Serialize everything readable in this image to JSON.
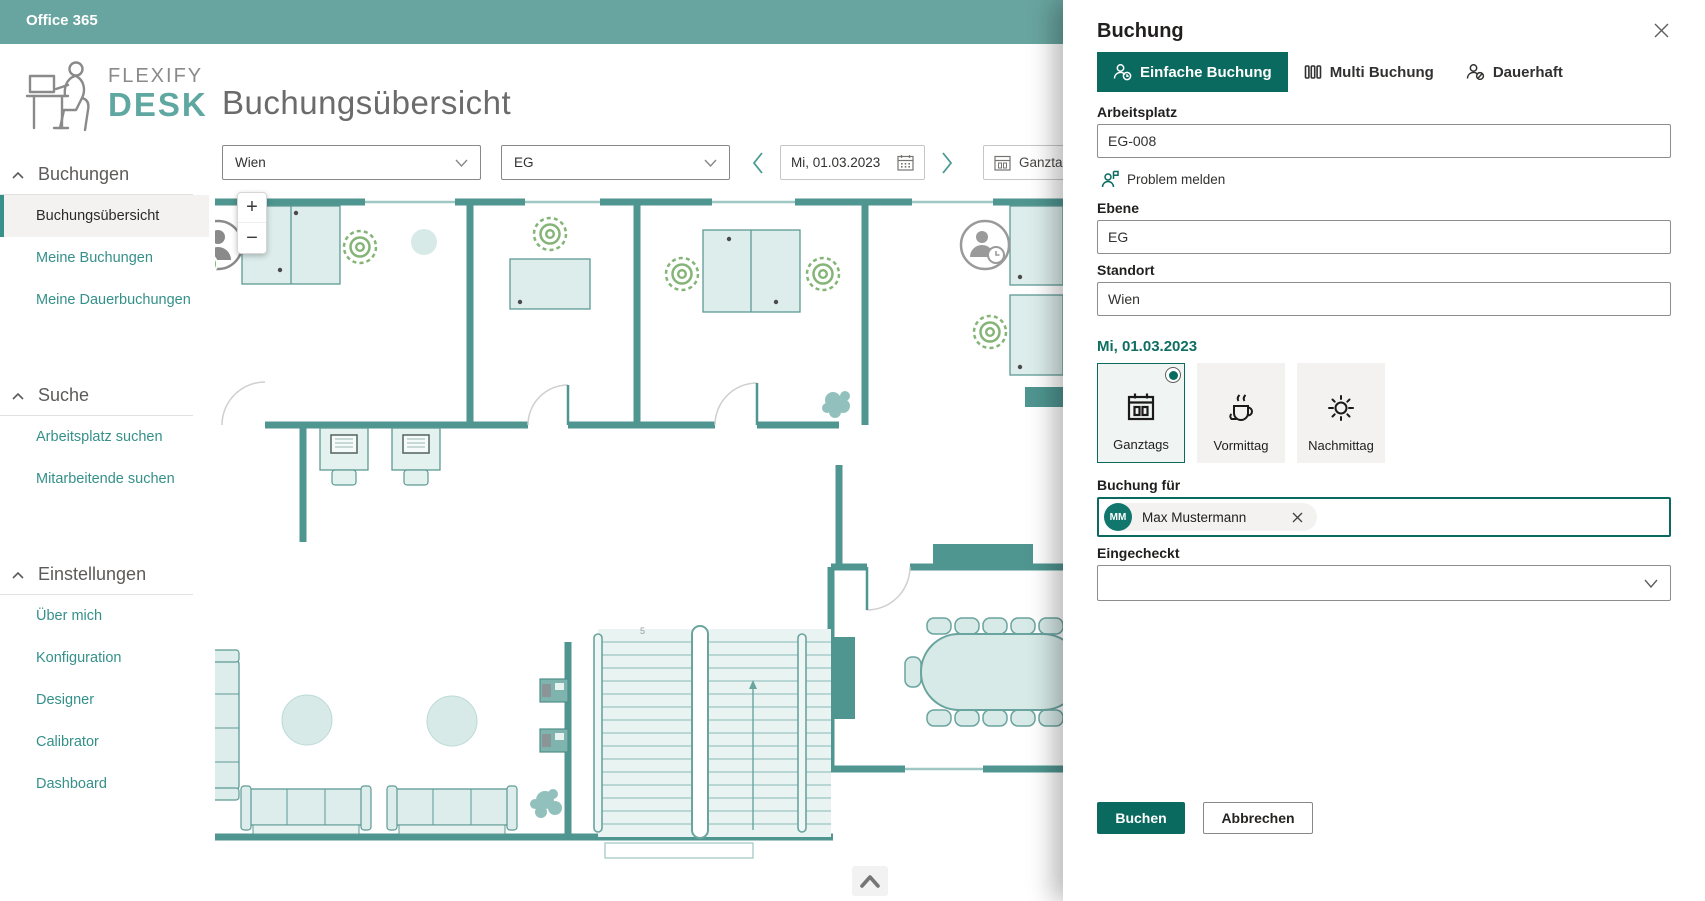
{
  "colors": {
    "top_bar": "#69a5a0",
    "brand_teal": "#5fa8a1",
    "accent": "#0b6a5f",
    "link_teal": "#35908a",
    "wall_teal": "#4f9590",
    "indicator_green": "#84b476"
  },
  "top_bar": {
    "app_title": "Office 365"
  },
  "logo": {
    "word1": "FLEXIFY",
    "word2": "DESK"
  },
  "sidebar": {
    "sections": [
      {
        "label": "Buchungen",
        "items": [
          {
            "label": "Buchungsübersicht",
            "active": true
          },
          {
            "label": "Meine Buchungen",
            "active": false
          },
          {
            "label": "Meine Dauerbuchungen",
            "active": false
          }
        ]
      },
      {
        "label": "Suche",
        "items": [
          {
            "label": "Arbeitsplatz suchen",
            "active": false
          },
          {
            "label": "Mitarbeitende suchen",
            "active": false
          }
        ]
      },
      {
        "label": "Einstellungen",
        "items": [
          {
            "label": "Über mich",
            "active": false
          },
          {
            "label": "Konfiguration",
            "active": false
          },
          {
            "label": "Designer",
            "active": false
          },
          {
            "label": "Calibrator",
            "active": false
          },
          {
            "label": "Dashboard",
            "active": false
          }
        ]
      }
    ]
  },
  "main": {
    "page_title": "Buchungsübersicht",
    "filters": {
      "location": "Wien",
      "level": "EG",
      "date": "Mi, 01.03.2023",
      "slot": "Ganzta"
    },
    "map": {
      "zoom_in": "+",
      "zoom_out": "−",
      "stair_label": "5"
    }
  },
  "panel": {
    "title": "Buchung",
    "tabs": [
      {
        "label": "Einfache Buchung",
        "selected": true
      },
      {
        "label": "Multi Buchung",
        "selected": false
      },
      {
        "label": "Dauerhaft",
        "selected": false
      }
    ],
    "arbeitsplatz": {
      "label": "Arbeitsplatz",
      "value": "EG-008"
    },
    "problem_link": "Problem melden",
    "ebene": {
      "label": "Ebene",
      "value": "EG"
    },
    "standort": {
      "label": "Standort",
      "value": "Wien"
    },
    "date_heading": "Mi, 01.03.2023",
    "slots": [
      {
        "label": "Ganztags",
        "selected": true
      },
      {
        "label": "Vormittag",
        "selected": false
      },
      {
        "label": "Nachmittag",
        "selected": false
      }
    ],
    "booking_for": {
      "label": "Buchung für",
      "person_name": "Max Mustermann",
      "person_initials": "MM"
    },
    "checked_in": {
      "label": "Eingecheckt",
      "value": ""
    },
    "actions": {
      "submit": "Buchen",
      "cancel": "Abbrechen"
    }
  }
}
